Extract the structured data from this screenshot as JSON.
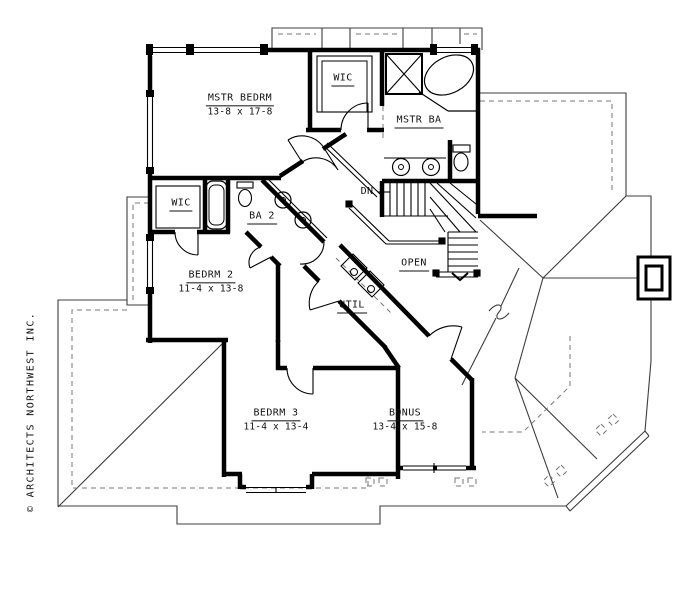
{
  "drawing": {
    "background": "#ffffff",
    "line_color": "#000000",
    "watermark": "© ARCHITECTS NORTHWEST INC.",
    "labels": {
      "mstr_bedrm": {
        "name": "MSTR BEDRM",
        "dims": "13-8 x 17-8"
      },
      "wic_top": {
        "name": "WIC"
      },
      "mstr_ba": {
        "name": "MSTR BA"
      },
      "wic_left": {
        "name": "WIC"
      },
      "ba_2": {
        "name": "BA 2"
      },
      "bedrm_2": {
        "name": "BEDRM 2",
        "dims": "11-4 x 13-8"
      },
      "stairs_dn": {
        "name": "DN"
      },
      "open_below": {
        "name": "OPEN"
      },
      "util": {
        "name": "UTIL"
      },
      "bedrm_3": {
        "name": "BEDRM 3",
        "dims": "11-4 x 13-4"
      },
      "bonus": {
        "name": "BONUS",
        "dims": "13-4 x 15-8"
      }
    }
  }
}
